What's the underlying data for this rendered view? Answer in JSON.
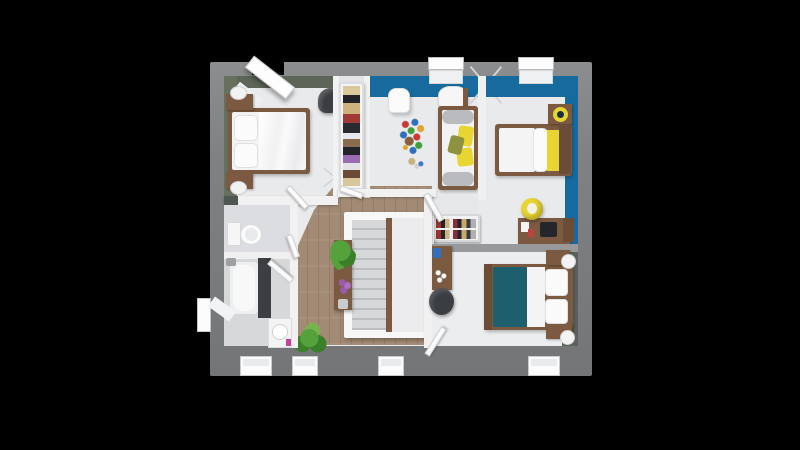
{
  "scene": {
    "type": "3d-floor-plan-top-view",
    "floor": "upper floor with three bedrooms, kids room, bathroom, wc, hallway and staircase",
    "background_color": "#000000",
    "palette": {
      "bg": "#000000",
      "wall_outer": "#7f8183",
      "floor_light": "#e9eaec",
      "floor_gray": "#dcdde0",
      "wood_floor": "#a28a75",
      "wood_furniture": "#7b5a41",
      "wood_dark": "#6b4d37",
      "accent_blue": "#176a9e",
      "accent_olive": "#67705f",
      "accent_olive_dark": "#5d6558",
      "accent_dark_green": "#59635b",
      "teal_bedding": "#1e5f6e",
      "yellow_accent": "#e8d531",
      "stair_gray": "#d6d7d9",
      "stair_dark": "#bcbdc0",
      "plant_green": "#55a23c",
      "plant_dark": "#3c7f2a",
      "chair_dark": "#3a3d41",
      "bolster_gray": "#b9bbbe",
      "toy_red": "#c93a33",
      "toy_blue": "#2f6fbe",
      "toy_green": "#3d9e3a",
      "purple_flower": "#9a5cae",
      "pink_bottle": "#c2459a",
      "laptop_dark": "#23262a"
    },
    "rooms": [
      {
        "id": "bedroom-top-left",
        "accent": "#67705f",
        "furniture": [
          "double-bed",
          "nightstand-with-lamp",
          "nightstand-with-lamp",
          "armchair",
          "roof-window"
        ]
      },
      {
        "id": "wardrobe-niche",
        "furniture": [
          "open-wardrobe-with-clothes"
        ]
      },
      {
        "id": "kids-room",
        "accent": "#176a9e",
        "furniture": [
          "daybed-with-pillows",
          "white-chair",
          "toy-bricks",
          "side-table",
          "drying-rack",
          "window"
        ]
      },
      {
        "id": "bedroom-top-right",
        "accent": "#176a9e",
        "furniture": [
          "single-bed-yellow-blanket",
          "nightstand-with-lamp",
          "desk-with-laptop",
          "yellow-chair",
          "window"
        ]
      },
      {
        "id": "hallway",
        "floor": "#a28a75",
        "furniture": [
          "staircase",
          "console-table-with-plants",
          "potted-plant",
          "shoe-rack"
        ]
      },
      {
        "id": "wc",
        "furniture": [
          "toilet"
        ]
      },
      {
        "id": "bathroom",
        "furniture": [
          "bathtub",
          "storage-cabinet",
          "washbasin",
          "window"
        ]
      },
      {
        "id": "bedroom-bottom-right",
        "accent": "#59635b",
        "furniture": [
          "double-bed-teal-bedding",
          "nightstand-with-lamp",
          "nightstand-with-lamp",
          "small-desk",
          "armchair",
          "window"
        ]
      }
    ],
    "window_count": 8,
    "door_count": 6
  }
}
